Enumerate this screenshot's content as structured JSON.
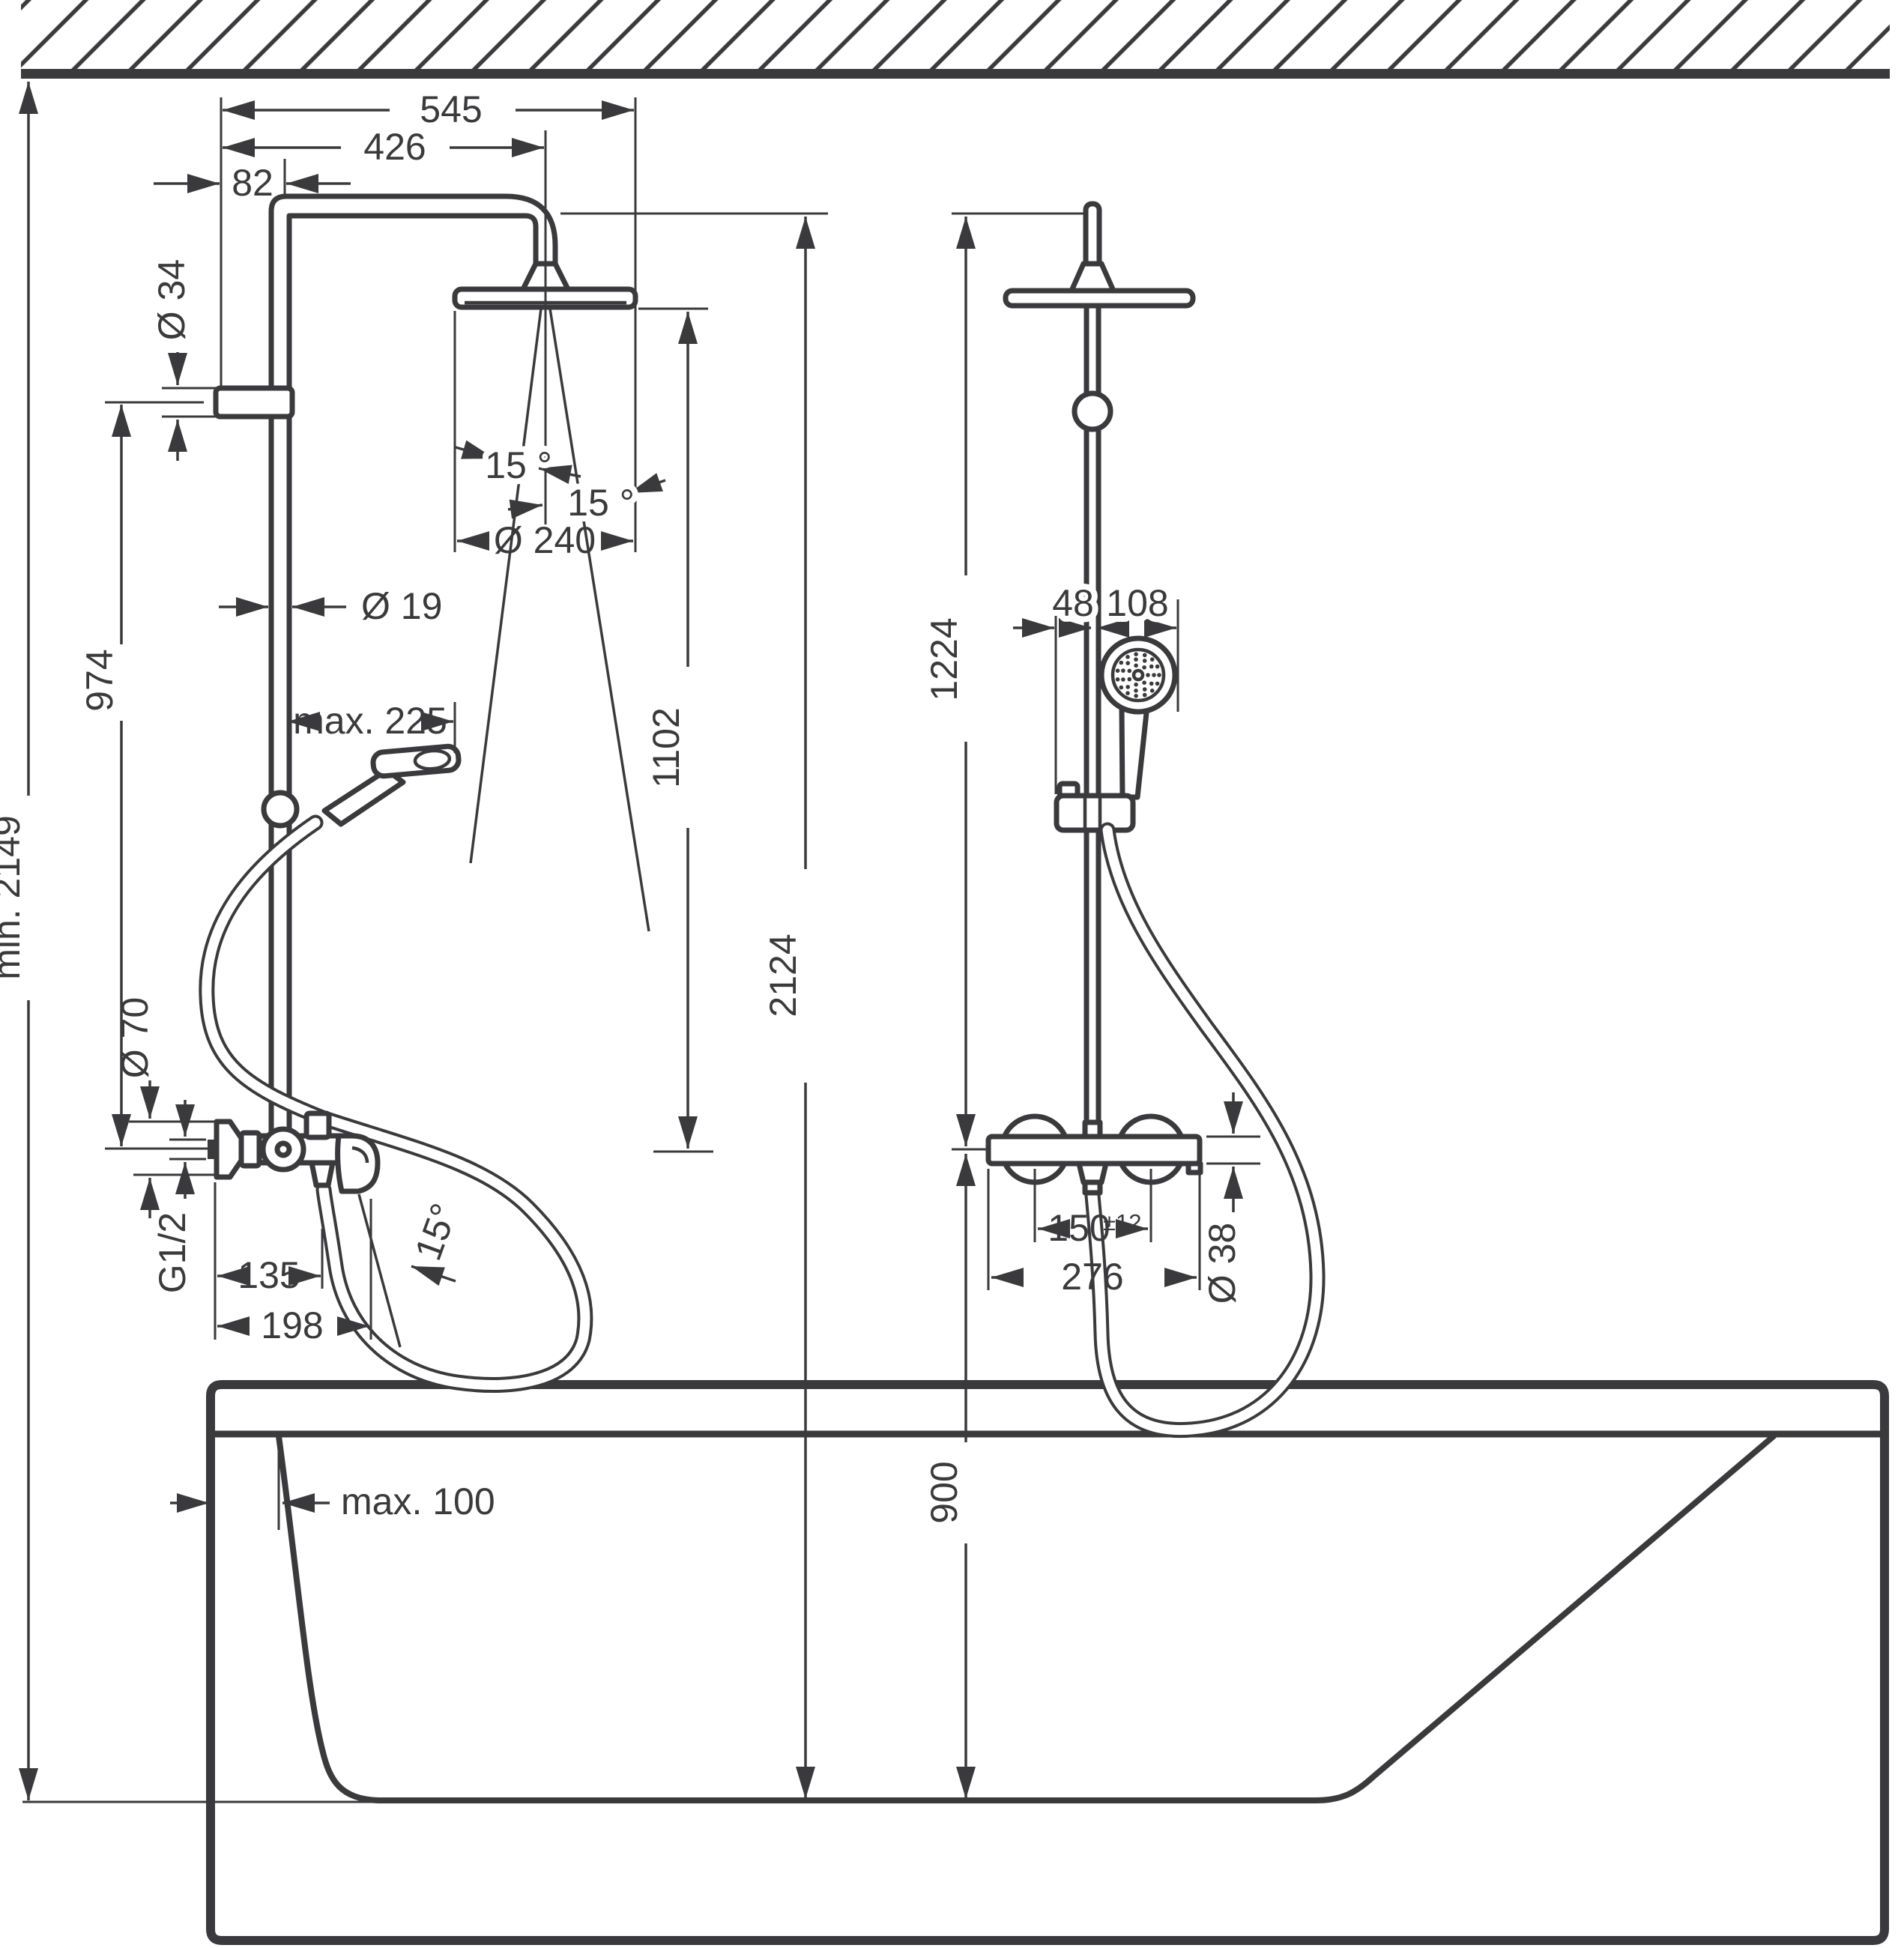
{
  "colors": {
    "line": "#3a3a3c",
    "background": "#ffffff"
  },
  "left_view": {
    "labels": {
      "w545": "545",
      "w426": "426",
      "w82": "82",
      "o34": "Ø 34",
      "h974": "974",
      "o19": "Ø 19",
      "max225": "max. 225",
      "min2149": "min. 2149",
      "o70": "Ø 70",
      "g12": "G1/2",
      "w135": "135",
      "w198": "198",
      "angle_left": "15 °",
      "angle_right": "15 °",
      "angle_spout": "15°",
      "o240": "Ø 240",
      "h1102": "1102",
      "h2124": "2124"
    }
  },
  "right_view": {
    "labels": {
      "h1224": "1224",
      "w48": "48",
      "w108": "108",
      "w150": "150",
      "tol": "±12",
      "w276": "276",
      "o38": "Ø 38",
      "h900": "900"
    }
  },
  "bathtub": {
    "labels": {
      "max100": "max. 100"
    }
  }
}
